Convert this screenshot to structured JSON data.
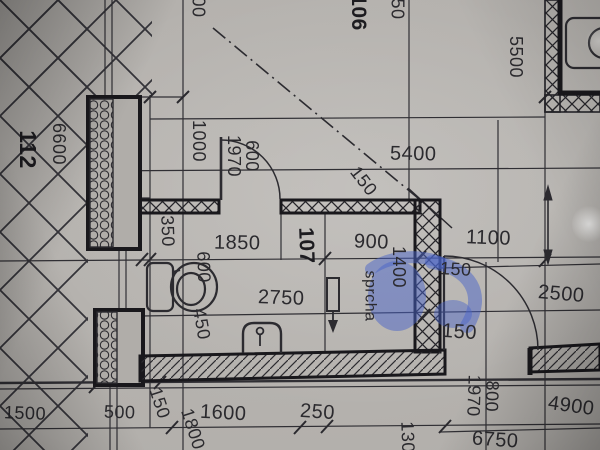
{
  "colors": {
    "paper": "#b2afab",
    "ink": "#2b2a2e",
    "wall": "#19181c",
    "pen_blue": "#4a63c8"
  },
  "rooms": {
    "left": {
      "number": "112"
    },
    "top": {
      "number": "106"
    },
    "main": {
      "number": "107"
    }
  },
  "labels": {
    "shower": "sprcha"
  },
  "dims": {
    "left_6600": "6600",
    "top_partial_left": "00",
    "top_partial_right": "50",
    "vert_5500": "5500",
    "top_5400": "5400",
    "wall_150_top": "150",
    "left_1000": "1000",
    "door_left_w": "600",
    "door_left_h": "1970",
    "niche_350": "350",
    "span_1850": "1850",
    "span_900": "900",
    "span_1100": "1100",
    "wall_150_right_top": "150",
    "shower_1400": "1400",
    "right_2500": "2500",
    "room_2750": "2750",
    "wc_600": "600",
    "wc_450": "450",
    "wall_150_right_bot": "150",
    "bottom_1500": "1500",
    "bottom_500": "500",
    "bottom_150": "150",
    "bottom_1800": "1800",
    "bottom_1600": "1600",
    "bottom_250": "250",
    "door_right_w": "800",
    "door_right_h": "1970",
    "bottom_4900": "4900",
    "bottom_130": "130",
    "bottom_6750": "6750"
  }
}
